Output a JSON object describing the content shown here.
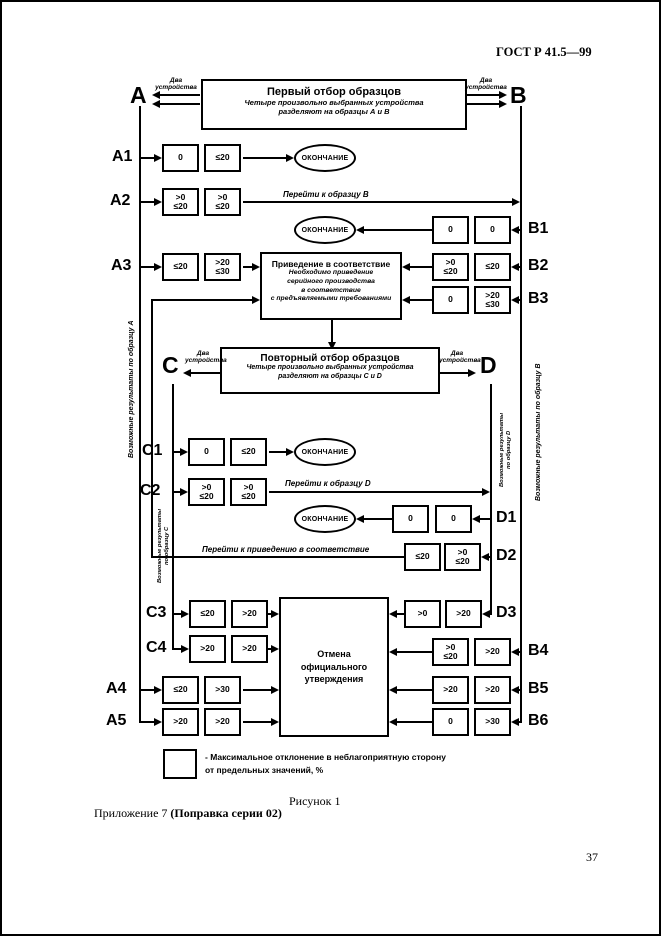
{
  "doc": {
    "header": "ГОСТ Р 41.5—99",
    "figure_caption": "Рисунок 1",
    "appendix": "Приложение 7 ",
    "appendix_bold": "(Поправка серии 02)",
    "page_number": "37"
  },
  "flow": {
    "first_selection": {
      "title": "Первый отбор образцов",
      "sub1": "Четыре произвольно выбранных устройства",
      "sub2": "разделяют на образцы А и В"
    },
    "reselection": {
      "title": "Повторный отбор образцов",
      "sub1": "Четыре произвольно выбранных устройства",
      "sub2": "разделяют на образцы C и D"
    },
    "conformity": {
      "title": "Приведение в соответствие",
      "sub1": "Необходимо приведение",
      "sub2": "серийного производства",
      "sub3": "в соответствие",
      "sub4": "с предъявляемыми требованиями"
    },
    "withdrawal": {
      "line1": "Отмена",
      "line2": "официального",
      "line3": "утверждения"
    },
    "end_label": "ОКОНЧАНИЕ",
    "two_devices": {
      "line1": "Два",
      "line2": "устройства"
    },
    "samples": {
      "a": "A",
      "b": "B",
      "c": "C",
      "d": "D"
    },
    "side_labels": {
      "a": "Возможные результаты по образцу А",
      "b": "Возможные результаты по образцу В",
      "c1": "Возможные результаты",
      "c2": "по образцу С",
      "d1": "Возможные результаты",
      "d2": "по образцу D"
    },
    "transitions": {
      "to_b": "Перейти к образцу В",
      "to_d": "Перейти к образцу D",
      "to_conformity": "Перейти к приведению в соответствие"
    },
    "rows": {
      "a1": {
        "label": "A1",
        "box1": [
          "0"
        ],
        "box2": [
          "≤20"
        ]
      },
      "a2": {
        "label": "A2",
        "box1": [
          ">0",
          "≤20"
        ],
        "box2": [
          ">0",
          "≤20"
        ]
      },
      "a3": {
        "label": "A3",
        "box1": [
          "≤20"
        ],
        "box2": [
          ">20",
          "≤30"
        ]
      },
      "a4": {
        "label": "A4",
        "box1": [
          "≤20"
        ],
        "box2": [
          ">30"
        ]
      },
      "a5": {
        "label": "A5",
        "box1": [
          ">20"
        ],
        "box2": [
          ">20"
        ]
      },
      "b1": {
        "label": "B1",
        "box1": [
          "0"
        ],
        "box2": [
          "0"
        ]
      },
      "b2": {
        "label": "B2",
        "box1": [
          ">0",
          "≤20"
        ],
        "box2": [
          "≤20"
        ]
      },
      "b3": {
        "label": "B3",
        "box1": [
          "0"
        ],
        "box2": [
          ">20",
          "≤30"
        ]
      },
      "b4": {
        "label": "B4",
        "box1": [
          ">0",
          "≤20"
        ],
        "box2": [
          ">20"
        ]
      },
      "b5": {
        "label": "B5",
        "box1": [
          ">20"
        ],
        "box2": [
          ">20"
        ]
      },
      "b6": {
        "label": "B6",
        "box1": [
          "0"
        ],
        "box2": [
          ">30"
        ]
      },
      "c1": {
        "label": "C1",
        "box1": [
          "0"
        ],
        "box2": [
          "≤20"
        ]
      },
      "c2": {
        "label": "C2",
        "box1": [
          ">0",
          "≤20"
        ],
        "box2": [
          ">0",
          "≤20"
        ]
      },
      "c3": {
        "label": "C3",
        "box1": [
          "≤20"
        ],
        "box2": [
          ">20"
        ]
      },
      "c4": {
        "label": "C4",
        "box1": [
          ">20"
        ],
        "box2": [
          ">20"
        ]
      },
      "d1": {
        "label": "D1",
        "box1": [
          "0"
        ],
        "box2": [
          "0"
        ]
      },
      "d2": {
        "label": "D2",
        "box1": [
          "≤20"
        ],
        "box2": [
          ">0",
          "≤20"
        ]
      },
      "d3": {
        "label": "D3",
        "box1": [
          ">0"
        ],
        "box2": [
          ">20"
        ]
      }
    },
    "legend": {
      "line1": "- Максимальное отклонение в неблагоприятную сторону",
      "line2": "от предельных значений, %"
    }
  }
}
